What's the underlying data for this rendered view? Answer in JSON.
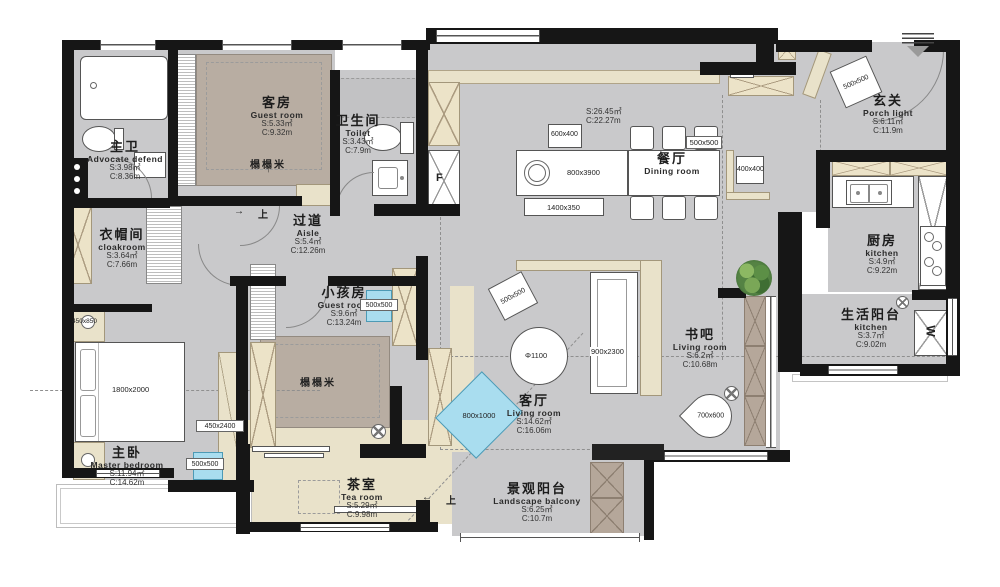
{
  "rooms": [
    {
      "id": "master-bath",
      "zh": "主卫",
      "en": "Advocate defend",
      "s": "S:3.98㎡",
      "c": "C:8.36m"
    },
    {
      "id": "guest-room",
      "zh": "客房",
      "en": "Guest room",
      "s": "S:5.33㎡",
      "c": "C:9.32m"
    },
    {
      "id": "toilet",
      "zh": "卫生间",
      "en": "Toilet",
      "s": "S:3.43㎡",
      "c": "C:7.9m"
    },
    {
      "id": "aisle",
      "zh": "过道",
      "en": "Aisle",
      "s": "S:5.4㎡",
      "c": "C:12.26m"
    },
    {
      "id": "cloakroom",
      "zh": "衣帽间",
      "en": "cloakroom",
      "s": "S:3.64㎡",
      "c": "C:7.66m"
    },
    {
      "id": "dining-room",
      "zh": "餐厅",
      "en": "Dining room",
      "s": "S:26.45㎡",
      "c": "C:22.27m"
    },
    {
      "id": "porch",
      "zh": "玄关",
      "en": "Porch light",
      "s": "S:6.11㎡",
      "c": "C:11.9m"
    },
    {
      "id": "kitchen",
      "zh": "厨房",
      "en": "kitchen",
      "s": "S:4.9㎡",
      "c": "C:9.22m"
    },
    {
      "id": "service-balcony",
      "zh": "生活阳台",
      "en": "kitchen",
      "s": "S:3.7㎡",
      "c": "C:9.02m"
    },
    {
      "id": "book-bar",
      "zh": "书吧",
      "en": "Living room",
      "s": "S:6.2㎡",
      "c": "C:10.68m"
    },
    {
      "id": "living-room",
      "zh": "客厅",
      "en": "Living room",
      "s": "S:14.62㎡",
      "c": "C:16.06m"
    },
    {
      "id": "kids-room",
      "zh": "小孩房",
      "en": "Guest room",
      "s": "S:9.6㎡",
      "c": "C:13.24m"
    },
    {
      "id": "master-bedroom",
      "zh": "主卧",
      "en": "Master bedroom",
      "s": "S:11.94㎡",
      "c": "C:14.62m"
    },
    {
      "id": "tea-room",
      "zh": "茶室",
      "en": "Tea room",
      "s": "S:5.29㎡",
      "c": "C:9.98m"
    },
    {
      "id": "landscape-balcony",
      "zh": "景观阳台",
      "en": "Landscape balcony",
      "s": "S:6.25㎡",
      "c": "C:10.7m"
    }
  ],
  "dims": {
    "box_600x400": "600x400",
    "island": "800x3900",
    "shelf_1400x350": "1400x350",
    "chair_500x500": "500x500",
    "side_400x400": "400x400",
    "porch_500x500": "500x500",
    "living_500x500": "500x500",
    "sofa": "900x2300",
    "rug": "800x1000",
    "fan_chair": "700x600",
    "circle_dia": "Φ1100",
    "bed": "1800x2000",
    "nightstand": "450x850",
    "wardrobe": "450x2400",
    "master_box": "500x500",
    "kids_box": "500x500"
  },
  "ann": {
    "tatami": "榻榻米",
    "up": "上",
    "arrow_right": "→",
    "arrow_left": "←",
    "arrow_up": "↑",
    "fridge": "F",
    "washer": "W"
  }
}
